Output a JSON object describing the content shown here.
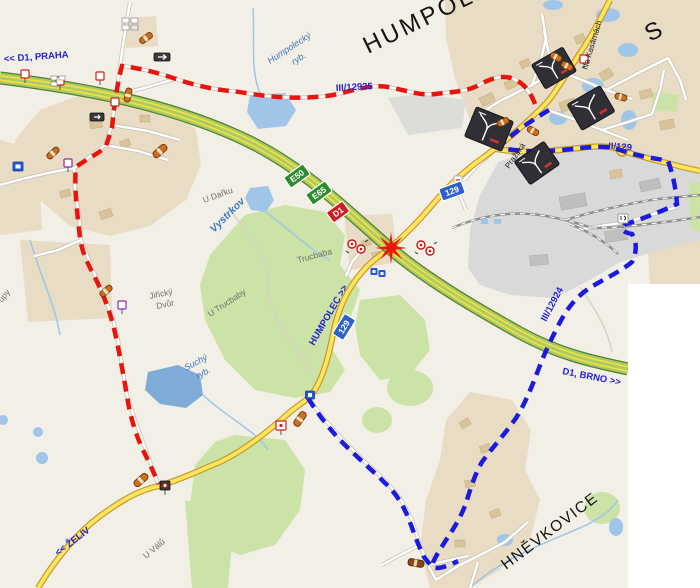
{
  "map": {
    "titles": {
      "humpolec": "HUMPOLEC",
      "partial_s": "S",
      "hnevkovice": "HNĚVKOVICE",
      "partial_upy": "upy"
    },
    "directions": {
      "d1_praha": "<< D1, PRAHA",
      "d1_brno": "D1, BRNO >>",
      "zeliv": "<< ŽELIV",
      "humpolec": "HUMPOLEC >>"
    },
    "road_refs": {
      "iii12935": "III/12935",
      "ii129": "II/129",
      "iii12924": "III/12924"
    },
    "shields": {
      "e50": "E50",
      "e65": "E65",
      "d1": "D1",
      "r129a": "129",
      "r129b": "129"
    },
    "streets": {
      "prazska": "Pražská",
      "na_kasarnach": "Na Kasárnách"
    },
    "places": {
      "u_darku": "U Dařku",
      "vystrkov": "Vystrkov",
      "trucbaba": "Trucbaba",
      "u_trucbaby": "U Trucbaby",
      "jiricky_line1": "Jiřický",
      "jiricky_line2": "Dvůr",
      "u_valu": "U Válů"
    },
    "waters": {
      "humpolecky_line1": "Humpolecký",
      "humpolecky_line2": "ryb.",
      "suchy_line1": "Suchý",
      "suchy_line2": "ryb."
    },
    "icons": {
      "closure_star": "road-closure-star",
      "info_board": "detour-info-board",
      "barrel": "construction-barrier",
      "no_entry": "no-entry-sign-cluster",
      "traffic_sign": "traffic-sign",
      "blue_sign": "blue-service-sign",
      "arrow_sign": "dark-arrow-sign"
    },
    "colors": {
      "detour_red": "#e8150d",
      "detour_blue": "#1b1bdf",
      "motorway_green": "#abcb69",
      "motorway_stripe": "#f5e13c",
      "road_yellow": "#ffe45e",
      "water": "#9fc6e8",
      "forest": "#cbe3a6",
      "urban": "#e8dcc4",
      "industrial": "#d9d9d9",
      "label_blue": "#2323cd"
    }
  }
}
